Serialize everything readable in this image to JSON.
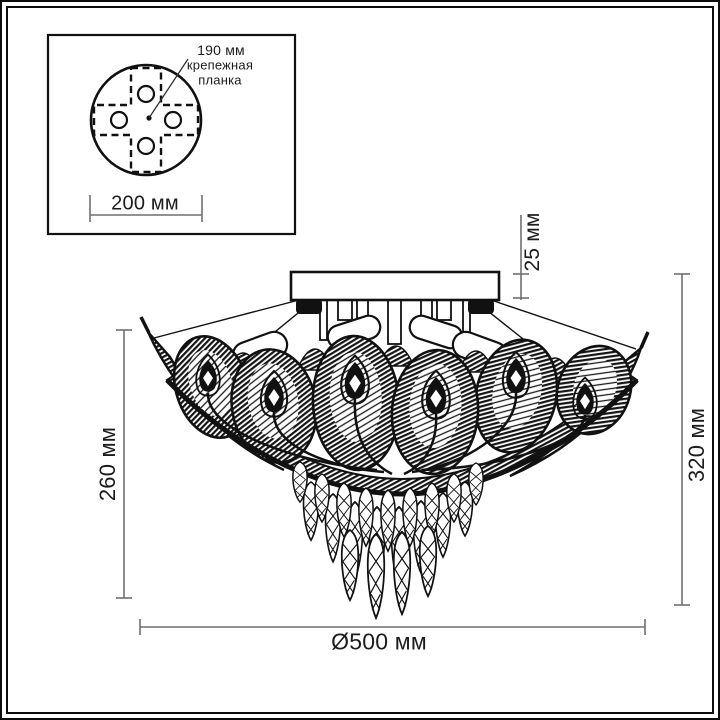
{
  "inset": {
    "dim_hole_spacing": "190 мм",
    "bracket_line1": "крепежная",
    "bracket_line2": "планка",
    "dim_plate_diameter": "200 мм"
  },
  "dimensions": {
    "canopy_height": "25 мм",
    "shade_height": "260 мм",
    "total_height": "320 мм",
    "diameter": "Ø500 мм"
  },
  "colors": {
    "ink": "#111111",
    "dim_line": "#6f6f6f",
    "text": "#1c1c1c",
    "background": "#ffffff"
  }
}
